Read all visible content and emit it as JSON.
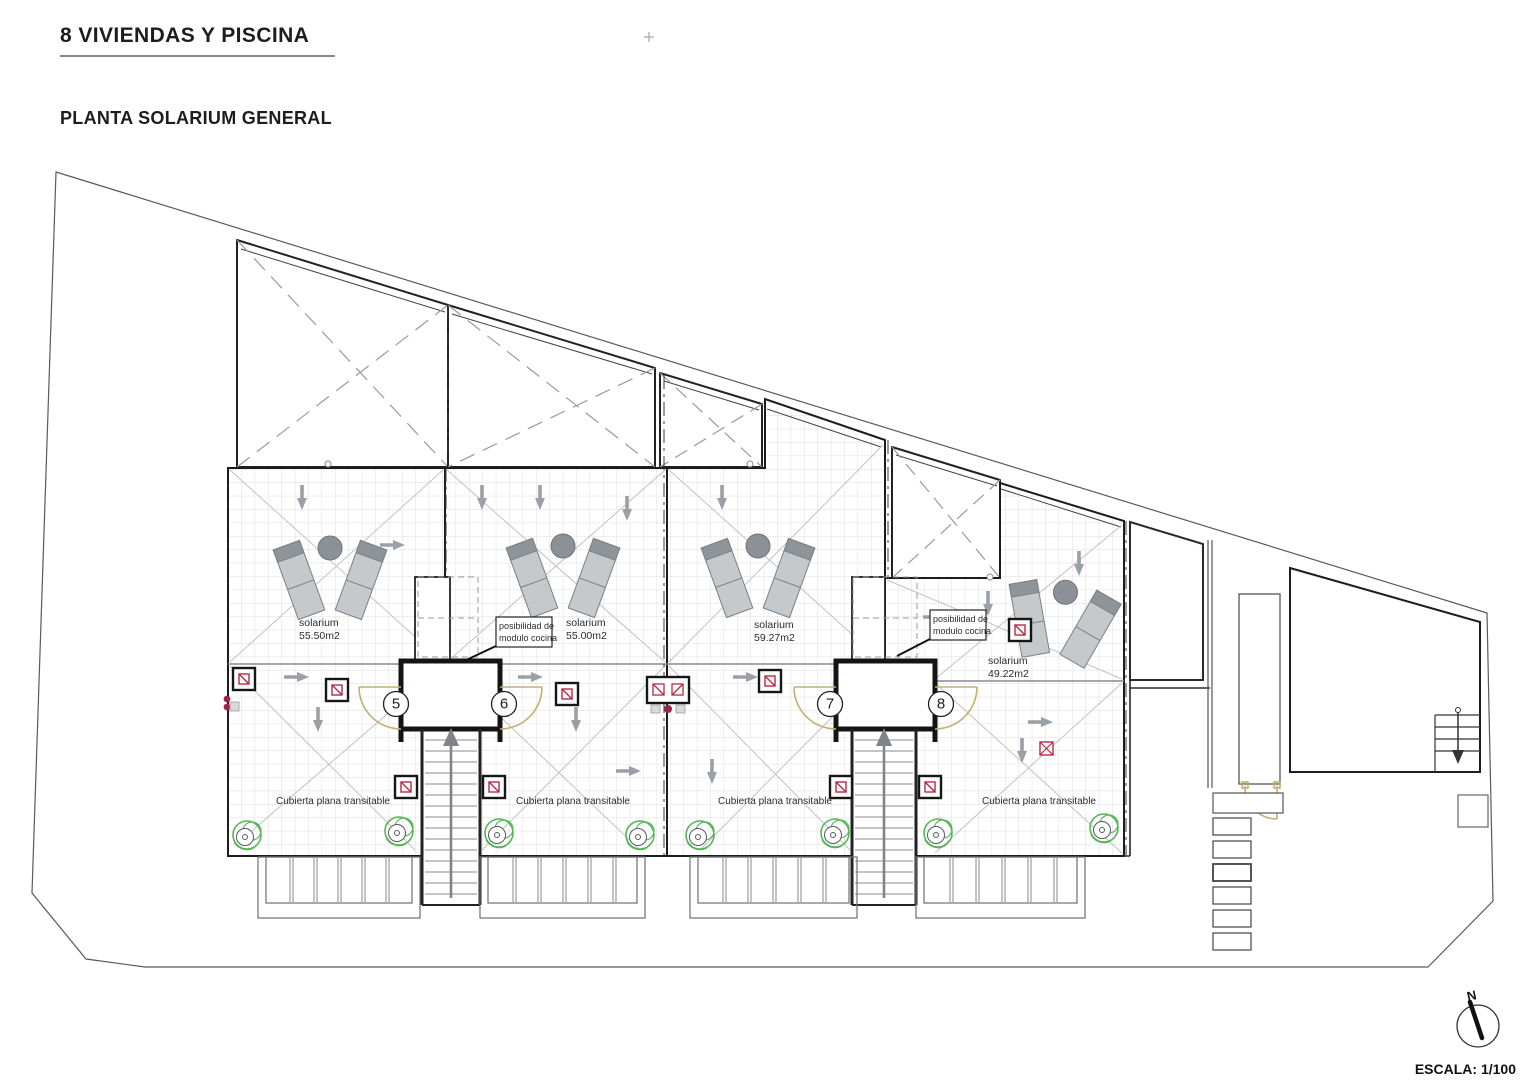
{
  "document": {
    "title": "8 VIVIENDAS Y PISCINA",
    "subtitle": "PLANTA SOLARIUM GENERAL",
    "scale": "ESCALA: 1/100",
    "north": "N"
  },
  "plan": {
    "units": [
      {
        "number": "5",
        "solarium_line1": "solarium",
        "solarium_line2": "55.50m2",
        "roof_label": "Cubierta plana transitable"
      },
      {
        "number": "6",
        "solarium_line1": "solarium",
        "solarium_line2": "55.00m2",
        "roof_label": "Cubierta plana transitable"
      },
      {
        "number": "7",
        "solarium_line1": "solarium",
        "solarium_line2": "59.27m2",
        "roof_label": "Cubierta plana transitable"
      },
      {
        "number": "8",
        "solarium_line1": "solarium",
        "solarium_line2": "49.22m2",
        "roof_label": "Cubierta plana transitable"
      }
    ],
    "notes": {
      "kitchen_line1": "posibilidad de",
      "kitchen_line2": "modulo cocina"
    },
    "colors": {
      "wall_line": "#1c1c1c",
      "secondary_line": "#555555",
      "grid": "#dedede",
      "door_tan": "#c3b070",
      "skylight_red": "#b52b45",
      "drain_green": "#58b558",
      "arrow_gray": "#9aa0a5",
      "lounger_gray": "#c5c9cc"
    }
  }
}
